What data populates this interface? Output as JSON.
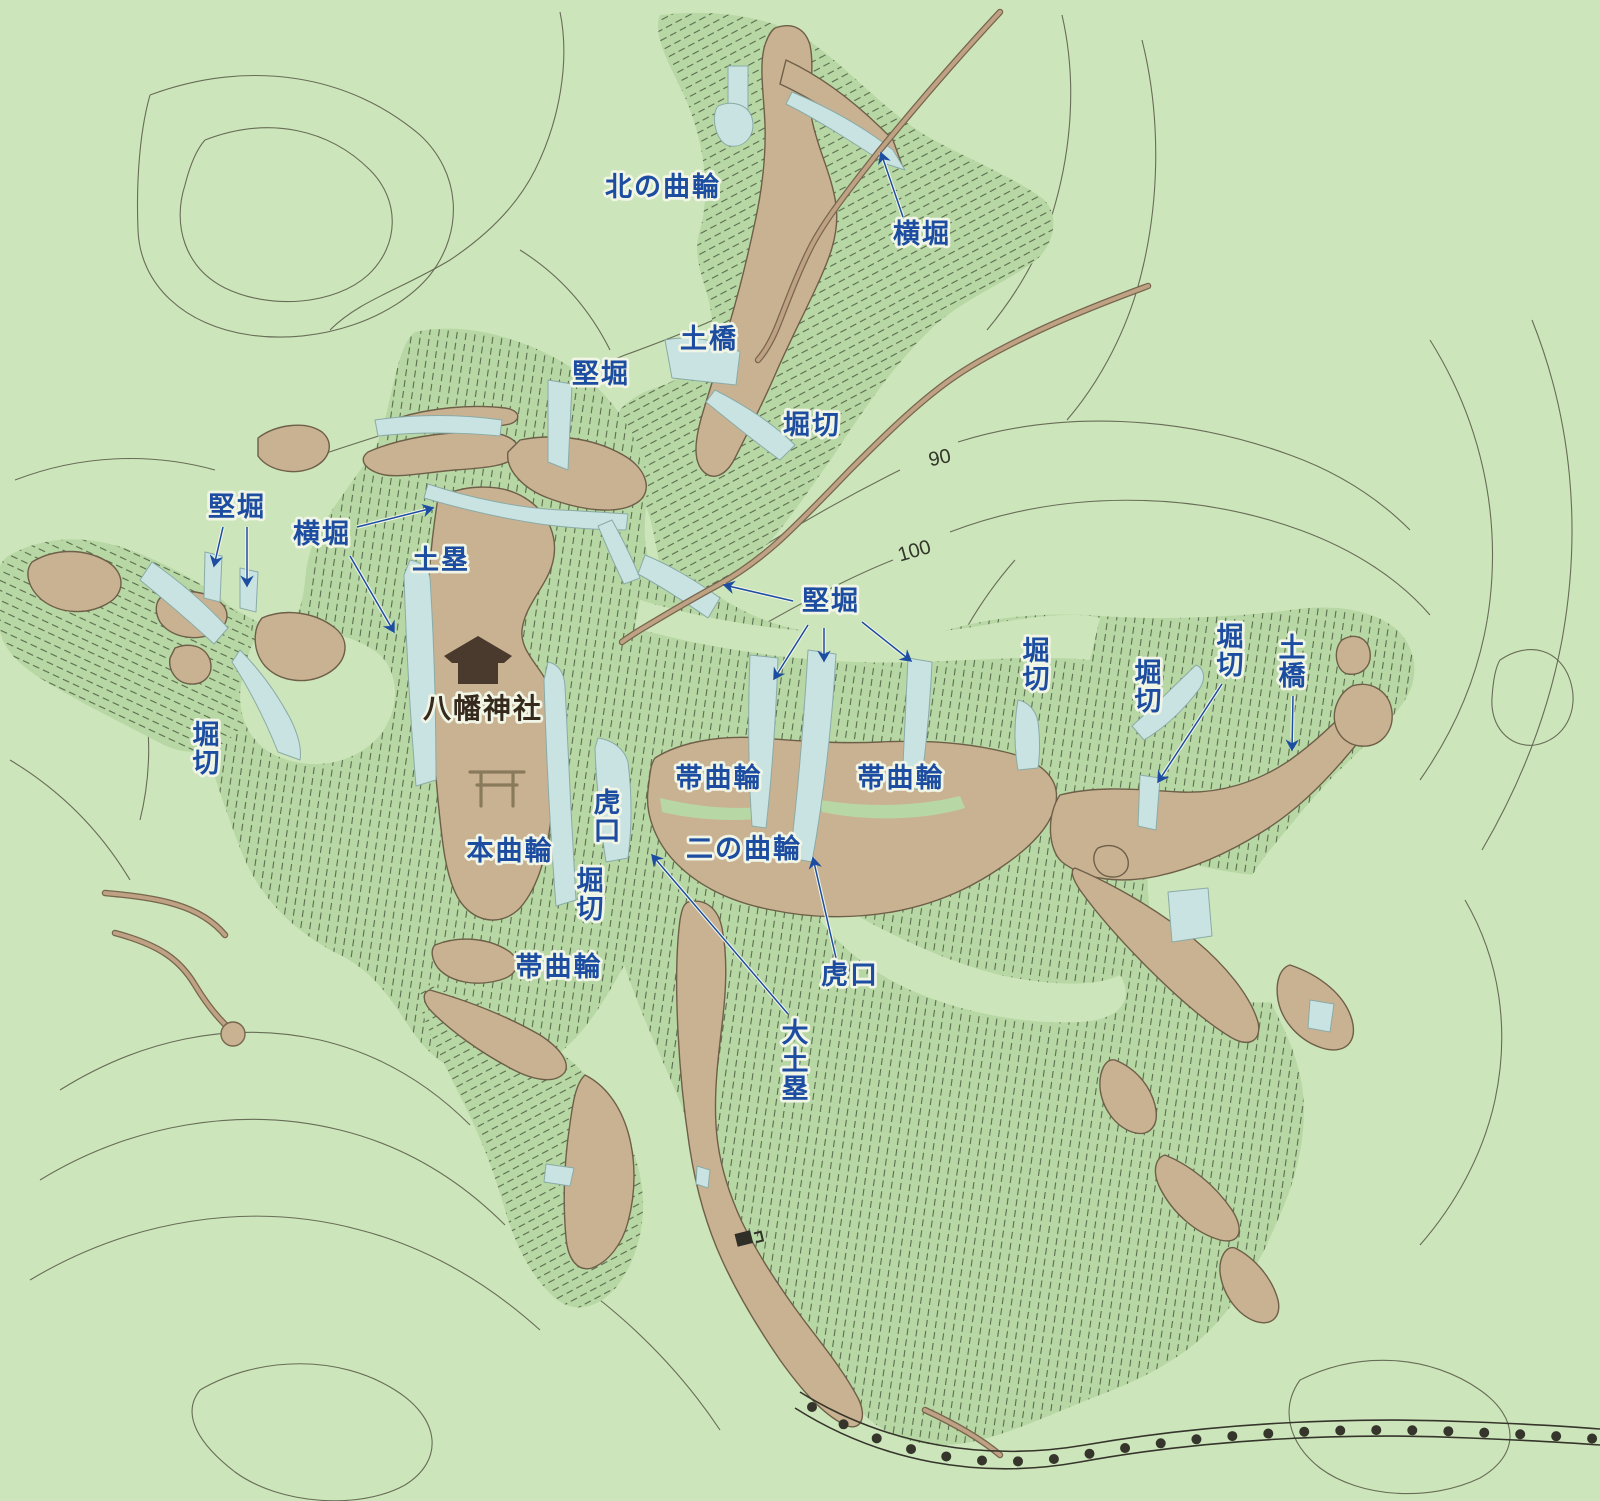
{
  "map": {
    "type": "castle-site-topographic-map",
    "colors": {
      "bg": "#cde5ba",
      "wash": "#b7d8a4",
      "hatch": "#5a6b4e",
      "tan": "#c9b292",
      "tan_edge": "#6e5f49",
      "water": "#c8e3e2",
      "water_edge": "#8aaba6",
      "contour": "#5c5f4c",
      "road": "#bfa183",
      "road_edge": "#77664f",
      "label_blue": "#1c4da0",
      "halo": "#f1f5e6",
      "dark_text": "#35291c",
      "icon_brown": "#4a3a2d",
      "torii": "#8a7a5c",
      "rail": "#35352b"
    },
    "icons": [
      {
        "id": "shrine-building-icon",
        "meaning": "shrine building"
      },
      {
        "id": "torii-gate-icon",
        "meaning": "torii gate map symbol"
      },
      {
        "id": "small-building-icon",
        "meaning": "small structure"
      }
    ],
    "labels": [
      {
        "id": "kita-no-kuruwa",
        "text": "北の曲輪",
        "x": 663,
        "y": 196,
        "orientation": "h",
        "style": "blue"
      },
      {
        "id": "yokobori-north",
        "text": "横堀",
        "x": 922,
        "y": 243,
        "orientation": "h",
        "style": "blue"
      },
      {
        "id": "dobashi-north",
        "text": "土橋",
        "x": 709,
        "y": 348,
        "orientation": "h",
        "style": "blue"
      },
      {
        "id": "tatebori-north",
        "text": "堅堀",
        "x": 601,
        "y": 383,
        "orientation": "h",
        "style": "blue"
      },
      {
        "id": "horikiri-north",
        "text": "堀切",
        "x": 812,
        "y": 434,
        "orientation": "h",
        "style": "blue"
      },
      {
        "id": "tatebori-west",
        "text": "堅堀",
        "x": 237,
        "y": 516,
        "orientation": "h",
        "style": "blue"
      },
      {
        "id": "yokobori-west",
        "text": "横堀",
        "x": 322,
        "y": 543,
        "orientation": "h",
        "style": "blue"
      },
      {
        "id": "dorui-west",
        "text": "土塁",
        "x": 441,
        "y": 569,
        "orientation": "h",
        "style": "blue"
      },
      {
        "id": "horikiri-west",
        "text": "堀切",
        "x": 207,
        "y": 744,
        "orientation": "v",
        "style": "blue"
      },
      {
        "id": "hachiman-jinja",
        "text": "八幡神社",
        "x": 483,
        "y": 718,
        "orientation": "h",
        "style": "dark"
      },
      {
        "id": "hon-kuruwa",
        "text": "本曲輪",
        "x": 510,
        "y": 860,
        "orientation": "h",
        "style": "blue"
      },
      {
        "id": "koguchi-center",
        "text": "虎口",
        "x": 608,
        "y": 812,
        "orientation": "v",
        "style": "blue"
      },
      {
        "id": "horikiri-center",
        "text": "堀切",
        "x": 591,
        "y": 890,
        "orientation": "v",
        "style": "blue"
      },
      {
        "id": "tatebori-center",
        "text": "堅堀",
        "x": 831,
        "y": 610,
        "orientation": "h",
        "style": "blue"
      },
      {
        "id": "obi-kuruwa-left",
        "text": "帯曲輪",
        "x": 719,
        "y": 787,
        "orientation": "h",
        "style": "blue"
      },
      {
        "id": "obi-kuruwa-right",
        "text": "帯曲輪",
        "x": 901,
        "y": 787,
        "orientation": "h",
        "style": "blue"
      },
      {
        "id": "ni-no-kuruwa",
        "text": "二の曲輪",
        "x": 744,
        "y": 858,
        "orientation": "h",
        "style": "blue"
      },
      {
        "id": "horikiri-east1",
        "text": "堀切",
        "x": 1037,
        "y": 660,
        "orientation": "v",
        "style": "blue"
      },
      {
        "id": "horikiri-east2",
        "text": "堀切",
        "x": 1149,
        "y": 682,
        "orientation": "v",
        "style": "blue"
      },
      {
        "id": "horikiri-east3",
        "text": "堀切",
        "x": 1231,
        "y": 646,
        "orientation": "v",
        "style": "blue"
      },
      {
        "id": "dobashi-east",
        "text": "土橋",
        "x": 1293,
        "y": 657,
        "orientation": "v",
        "style": "blue"
      },
      {
        "id": "obi-kuruwa-south",
        "text": "帯曲輪",
        "x": 559,
        "y": 976,
        "orientation": "h",
        "style": "blue"
      },
      {
        "id": "koguchi-south",
        "text": "虎口",
        "x": 850,
        "y": 984,
        "orientation": "h",
        "style": "blue"
      },
      {
        "id": "dai-dorui",
        "text": "大土塁",
        "x": 796,
        "y": 1042,
        "orientation": "v",
        "style": "blue"
      },
      {
        "id": "contour-90",
        "text": "90",
        "x": 941,
        "y": 464,
        "orientation": "h",
        "style": "contour",
        "rotation": -12
      },
      {
        "id": "contour-100",
        "text": "100",
        "x": 916,
        "y": 557,
        "orientation": "h",
        "style": "contour",
        "rotation": -16
      }
    ],
    "arrows": [
      {
        "from": "yokobori-north",
        "x1": 903,
        "y1": 217,
        "x2": 881,
        "y2": 153
      },
      {
        "from": "tatebori-west",
        "x1": 223,
        "y1": 527,
        "x2": 214,
        "y2": 566
      },
      {
        "from": "tatebori-west",
        "x1": 247,
        "y1": 527,
        "x2": 247,
        "y2": 586
      },
      {
        "from": "yokobori-west",
        "x1": 357,
        "y1": 527,
        "x2": 433,
        "y2": 508
      },
      {
        "from": "yokobori-west",
        "x1": 350,
        "y1": 556,
        "x2": 394,
        "y2": 632
      },
      {
        "from": "tatebori-center",
        "x1": 793,
        "y1": 601,
        "x2": 724,
        "y2": 585
      },
      {
        "from": "tatebori-center",
        "x1": 808,
        "y1": 625,
        "x2": 774,
        "y2": 679
      },
      {
        "from": "tatebori-center",
        "x1": 824,
        "y1": 628,
        "x2": 824,
        "y2": 661
      },
      {
        "from": "tatebori-center",
        "x1": 862,
        "y1": 622,
        "x2": 911,
        "y2": 661
      },
      {
        "from": "horikiri-east3",
        "x1": 1222,
        "y1": 684,
        "x2": 1158,
        "y2": 782
      },
      {
        "from": "dobashi-east",
        "x1": 1293,
        "y1": 696,
        "x2": 1292,
        "y2": 750
      },
      {
        "from": "koguchi-south",
        "x1": 836,
        "y1": 958,
        "x2": 813,
        "y2": 858
      },
      {
        "from": "dai-dorui",
        "x1": 788,
        "y1": 1014,
        "x2": 652,
        "y2": 855
      }
    ]
  }
}
